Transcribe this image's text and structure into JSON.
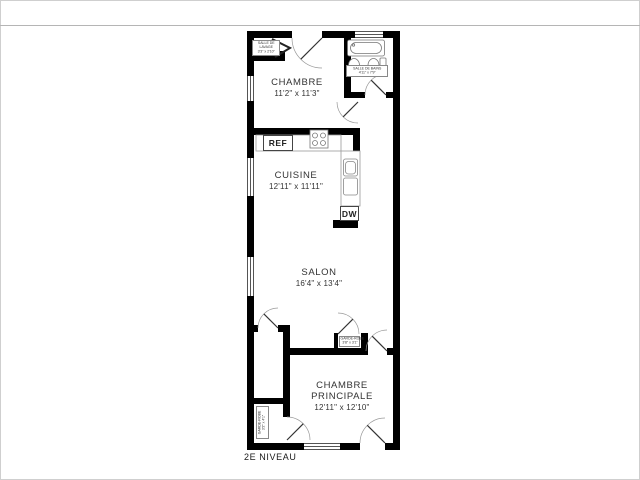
{
  "floor_plan": {
    "title": "2E NIVEAU",
    "rooms": {
      "chambre": {
        "name": "CHAMBRE",
        "dims": "11'2\" x 11'3\""
      },
      "cuisine": {
        "name": "CUISINE",
        "dims": "12'11\" x 11'11\""
      },
      "salon": {
        "name": "SALON",
        "dims": "16'4\" x 13'4\""
      },
      "chambre_principale": {
        "line1": "CHAMBRE",
        "line2": "PRINCIPALE",
        "dims": "12'11\" x 12'10\""
      },
      "salle_de_lavage": {
        "line1": "SALLE DE",
        "line2": "LAVAGE",
        "dims": "3'3\" x 2'10\""
      },
      "salle_de_bains": {
        "name": "SALLE DE BAINS",
        "dims": "4'11\" x 7'9\""
      },
      "garde_robe_hall": {
        "name": "GARDE-ROBE",
        "dims": "3'8\" x 3'1\""
      },
      "garde_robe_corridor": {
        "name": "GARDE-ROBE",
        "dims": "3'2\" x 4'1\""
      }
    },
    "appliances": {
      "refrigerator": "REF",
      "dishwasher": "DW"
    },
    "colors": {
      "wall": "#000000",
      "fixture_line": "#777777",
      "label_text": "#333333"
    }
  }
}
